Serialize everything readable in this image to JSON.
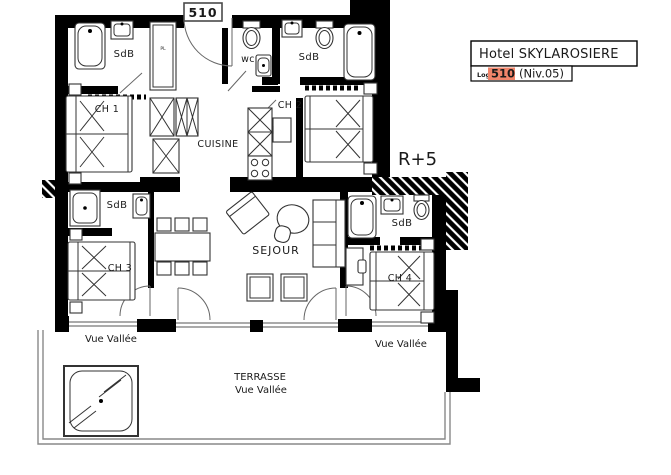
{
  "plan": {
    "unit_tag": "510",
    "floor_marker": "R+5",
    "labels": {
      "sdb_top_left": "SdB",
      "wc": "wc",
      "sdb_top_right": "SdB",
      "ch1": "CH 1",
      "ch2": "CH 2",
      "cuisine": "CUISINE",
      "sdb_mid_left": "SdB",
      "sdb_mid_right": "SdB",
      "ch3": "CH 3",
      "ch4": "CH 4",
      "sejour": "SEJOUR",
      "closet": "PL",
      "terrasse": "TERRASSE",
      "vue_vallee_left": "Vue Vallée",
      "vue_vallee_right": "Vue Vallée",
      "vue_vallee_terrace": "Vue Vallée"
    }
  },
  "title_block": {
    "hotel_name": "Hotel SKYLAROSIERE",
    "log_label": "Log",
    "unit_number": "510",
    "level": "(Niv.05)"
  },
  "colors": {
    "highlight_salmon": "#F0846A",
    "unit_red": "#C4261D",
    "wall_black": "#000000"
  }
}
